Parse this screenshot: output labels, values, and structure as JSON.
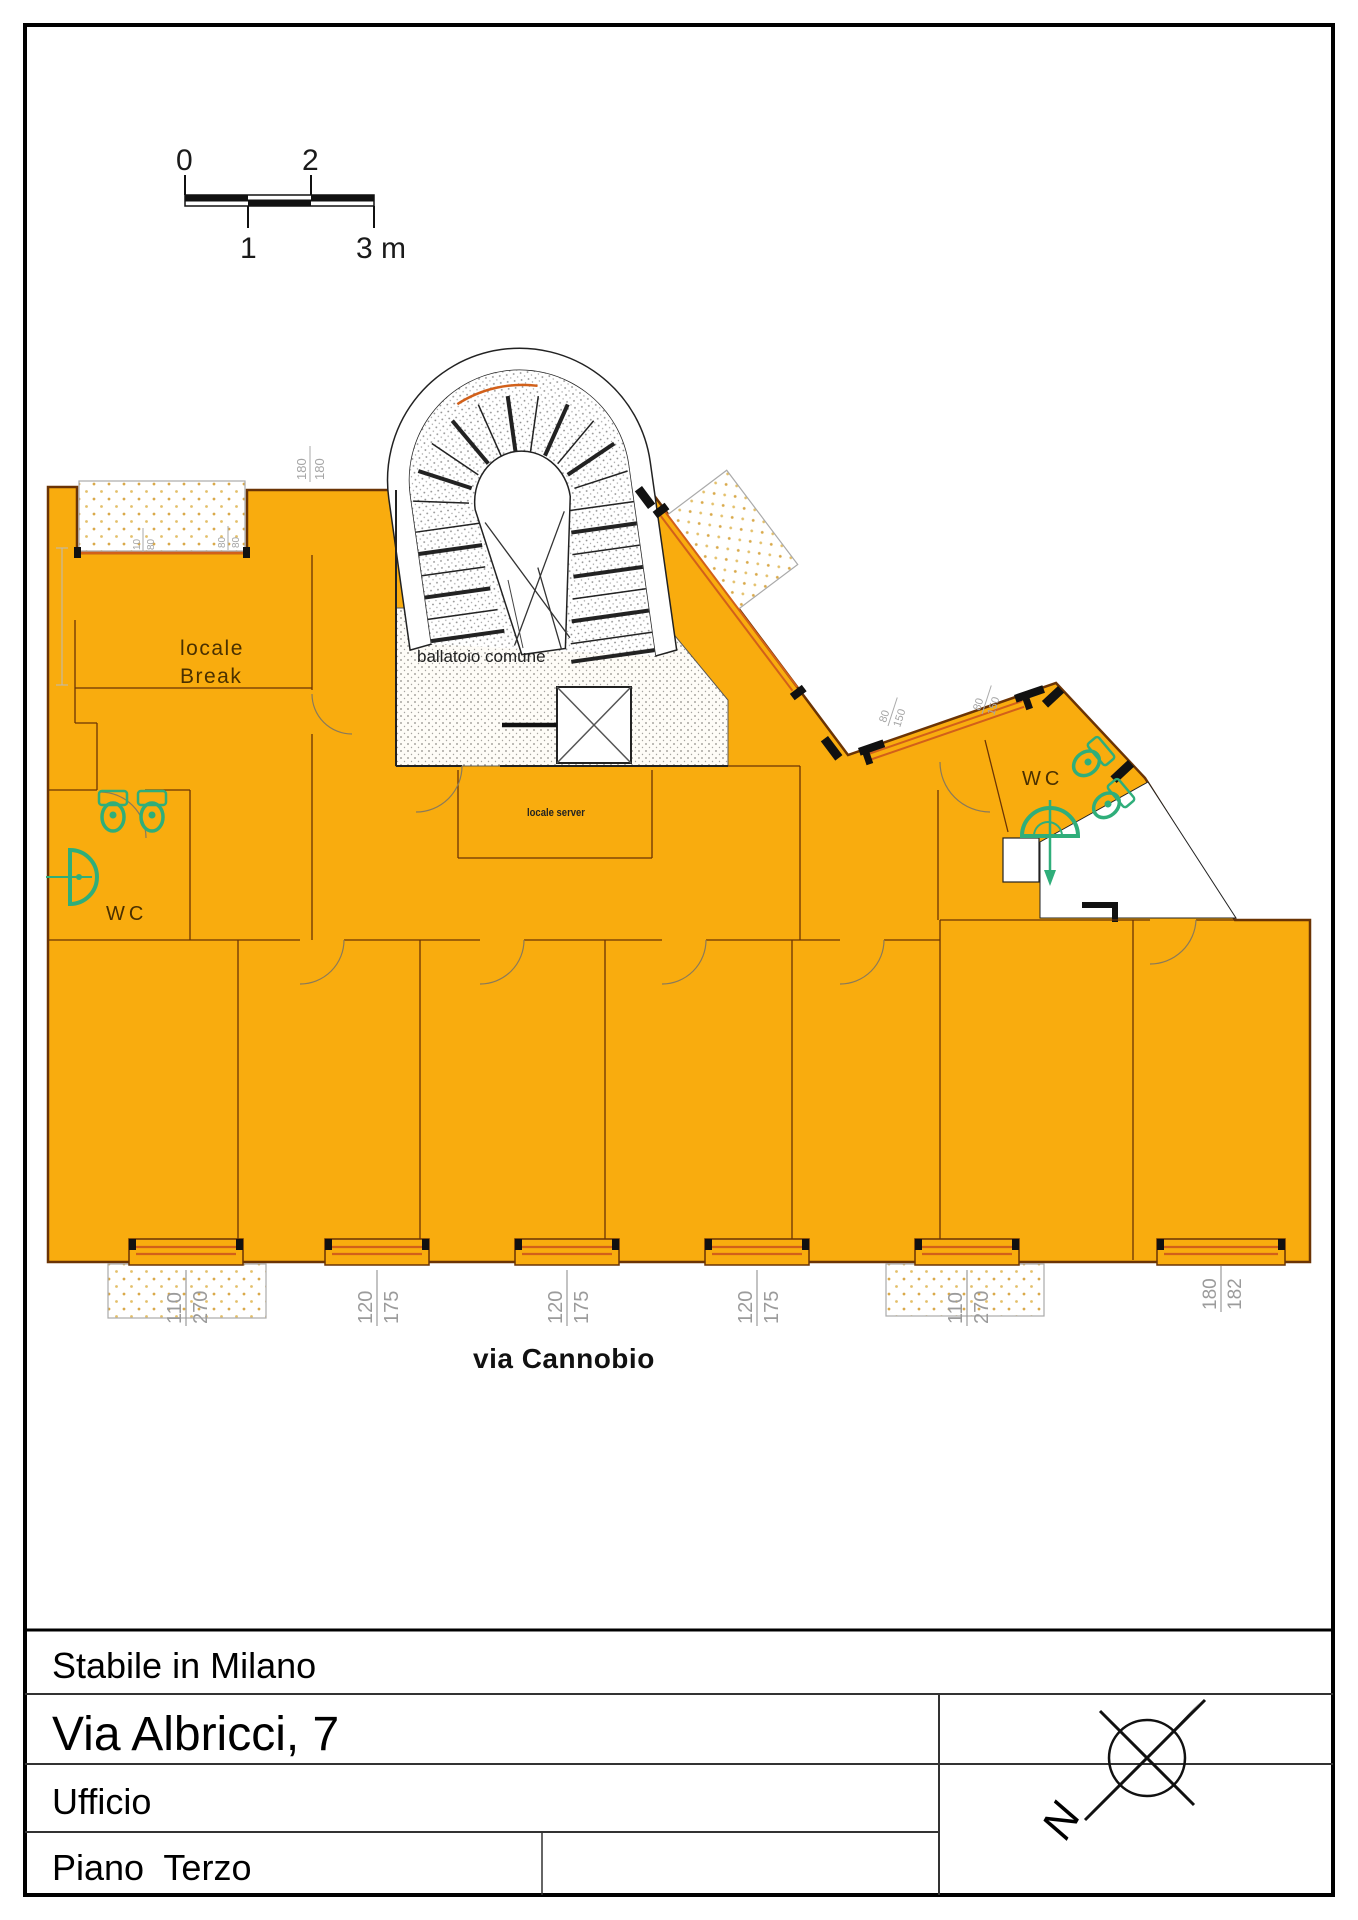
{
  "scale_bar": {
    "label_0": "0",
    "label_2": "2",
    "label_1": "1",
    "label_3": "3 m"
  },
  "plan": {
    "colors": {
      "fill": "#F9AC0E",
      "outline": "#6B3405",
      "wall": "#111111",
      "fixture_green": "#2FAE7A",
      "window_frame": "#D2601A",
      "dim_text": "#9B9B9B",
      "label_text": "#4A3000",
      "stair_dot": "#8C8C8C",
      "balcony_dot": "#D9A94A"
    },
    "labels": {
      "break_1": "locale",
      "break_2": "Break",
      "ballatoio": "ballatoio comune",
      "server": "locale server",
      "wc_left": "WC",
      "wc_right": "WC",
      "street": "via Cannobio"
    },
    "small_dims": [
      {
        "a": "180",
        "b": "180"
      },
      {
        "a": "10",
        "b": "80"
      },
      {
        "a": "80",
        "b": "80"
      },
      {
        "a": "80",
        "b": "150"
      },
      {
        "a": "80",
        "b": "150"
      }
    ],
    "window_dims": [
      {
        "a": "110",
        "b": "270"
      },
      {
        "a": "120",
        "b": "175"
      },
      {
        "a": "120",
        "b": "175"
      },
      {
        "a": "120",
        "b": "175"
      },
      {
        "a": "110",
        "b": "270"
      },
      {
        "a": "180",
        "b": "182"
      }
    ]
  },
  "title_block": {
    "row_1": "Stabile in Milano",
    "row_2": "Via Albricci, 7",
    "row_3": "Ufficio",
    "row_4": "Piano  Terzo",
    "north_label": "N"
  }
}
